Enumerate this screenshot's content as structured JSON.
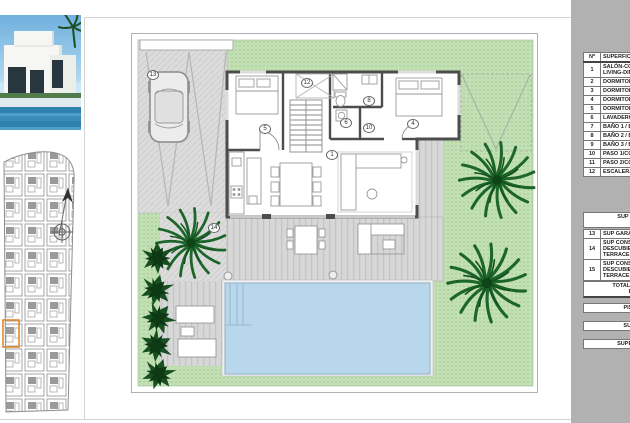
{
  "plan": {
    "room_labels": [
      {
        "n": "13",
        "x": 22,
        "y": 42
      },
      {
        "n": "5",
        "x": 134,
        "y": 96
      },
      {
        "n": "12",
        "x": 176,
        "y": 50
      },
      {
        "n": "8",
        "x": 238,
        "y": 68
      },
      {
        "n": "6",
        "x": 215,
        "y": 90
      },
      {
        "n": "10",
        "x": 238,
        "y": 95
      },
      {
        "n": "4",
        "x": 282,
        "y": 91
      },
      {
        "n": "1",
        "x": 201,
        "y": 122
      },
      {
        "n": "14",
        "x": 83,
        "y": 195
      }
    ],
    "colors": {
      "grass": "#c3e0b5",
      "paving": "#dcdcdc",
      "deck": "#d7d7d7",
      "pool": "#b9d7ec",
      "wall": "#4d4d4d",
      "palm": "#1d662a",
      "bush": "#174f20",
      "plot_highlight": "#e08a2d",
      "panel": "#b1b1b1"
    },
    "icons": [
      "north-arrow-icon",
      "compass-rose-icon",
      "car-icon",
      "palm-tree-icon",
      "bush-icon"
    ]
  },
  "legend": {
    "header": {
      "num": "nº",
      "name": "SUPERFICIE"
    },
    "rows": [
      {
        "num": "1",
        "lines": [
          "SALÓN-COM",
          "LIVING-DIN"
        ]
      },
      {
        "num": "2",
        "lines": [
          "DORMITORI"
        ]
      },
      {
        "num": "3",
        "lines": [
          "DORMITORI"
        ]
      },
      {
        "num": "4",
        "lines": [
          "DORMITORI"
        ]
      },
      {
        "num": "5",
        "lines": [
          "DORMITORI"
        ]
      },
      {
        "num": "6",
        "lines": [
          "LAVADERO,"
        ]
      },
      {
        "num": "7",
        "lines": [
          "BAÑO 1 / BA"
        ]
      },
      {
        "num": "8",
        "lines": [
          "BAÑO 2 / BA"
        ]
      },
      {
        "num": "9",
        "lines": [
          "BAÑO 3 / BA"
        ]
      },
      {
        "num": "10",
        "lines": [
          "PASO 1/CO"
        ]
      },
      {
        "num": "11",
        "lines": [
          "PASO 2/CO"
        ]
      },
      {
        "num": "12",
        "lines": [
          "ESCALERA 1"
        ]
      }
    ],
    "section2": [
      "SUP CONSTRUIDA",
      "INTERIO"
    ],
    "rows2": [
      {
        "num": "13",
        "lines": [
          "SUP GARAG"
        ]
      },
      {
        "num": "14",
        "lines": [
          "SUP CONST",
          "DESCUBIERT",
          "TERRACE A"
        ]
      },
      {
        "num": "15",
        "lines": [
          "SUP CONST",
          "DESCUBIERT",
          "TERRACE A"
        ]
      }
    ],
    "total": [
      "TOTAL SUP CONSTRU",
      "BUILT PRI"
    ],
    "extras": [
      "PISCINA / SWI",
      "SUP. JARDÍN /",
      "SUPERFICIE PARC"
    ]
  }
}
